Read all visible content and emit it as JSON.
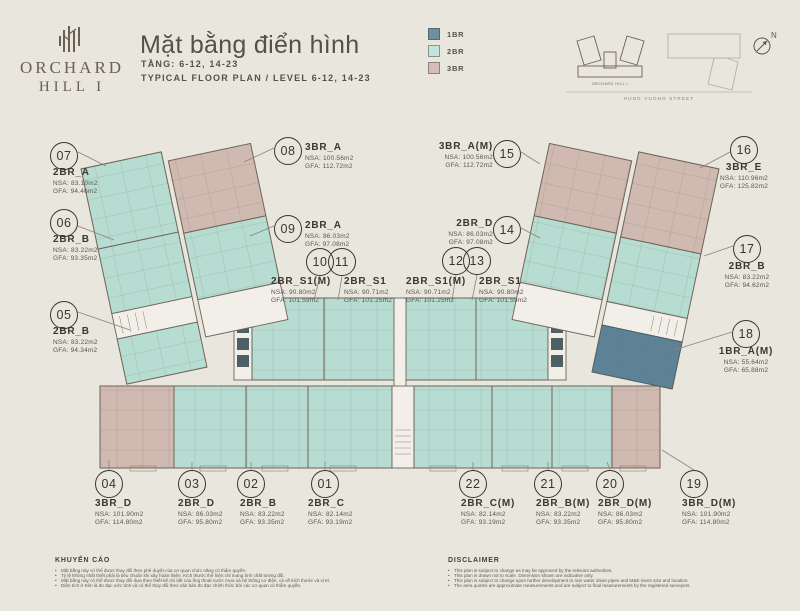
{
  "header": {
    "brand_line1": "ORCHARD",
    "brand_line2": "HILL I",
    "title": "Mặt bằng điển hình",
    "subtitle_vi": "TẦNG: 6-12, 14-23",
    "subtitle_en": "TYPICAL FLOOR PLAN / LEVEL 6-12, 14-23"
  },
  "legend": {
    "items": [
      {
        "label": "1BR",
        "color": "#6e8fa0"
      },
      {
        "label": "2BR",
        "color": "#c3e4da"
      },
      {
        "label": "3BR",
        "color": "#d4beb5"
      }
    ]
  },
  "site_key": {
    "building_label": "ORCHARD HILL I",
    "street_label": "HUNG VUONG STREET",
    "compass": "N"
  },
  "units": [
    {
      "no": "01",
      "type": "2BR_C",
      "nsa": "NSA: 82.14m2",
      "gfa": "GFA: 93.19m2"
    },
    {
      "no": "02",
      "type": "2BR_B",
      "nsa": "NSA: 83.22m2",
      "gfa": "GFA: 93.35m2"
    },
    {
      "no": "03",
      "type": "2BR_D",
      "nsa": "NSA: 86.03m2",
      "gfa": "GFA: 95.80m2"
    },
    {
      "no": "04",
      "type": "3BR_D",
      "nsa": "NSA: 101.90m2",
      "gfa": "GFA: 114.80m2"
    },
    {
      "no": "05",
      "type": "2BR_B",
      "nsa": "NSA: 83.22m2",
      "gfa": "GFA: 94.34m2"
    },
    {
      "no": "06",
      "type": "2BR_B",
      "nsa": "NSA: 83.22m2",
      "gfa": "GFA: 93.35m2"
    },
    {
      "no": "07",
      "type": "2BR_A",
      "nsa": "NSA: 83.10m2",
      "gfa": "GFA: 94.46m2"
    },
    {
      "no": "08",
      "type": "3BR_A",
      "nsa": "NSA: 100.56m2",
      "gfa": "GFA: 112.72m2"
    },
    {
      "no": "09",
      "type": "2BR_A",
      "nsa": "NSA: 86.03m2",
      "gfa": "GFA: 97.08m2"
    },
    {
      "no": "10",
      "type": "2BR_S1(M)",
      "nsa": "NSA: 90.80m2",
      "gfa": "GFA: 101.59m2"
    },
    {
      "no": "11",
      "type": "2BR_S1",
      "nsa": "NSA: 90.71m2",
      "gfa": "GFA: 101.25m2"
    },
    {
      "no": "12",
      "type": "2BR_S1(M)",
      "nsa": "NSA: 90.71m2",
      "gfa": "GFA: 101.25m2"
    },
    {
      "no": "13",
      "type": "2BR_S1",
      "nsa": "NSA: 90.80m2",
      "gfa": "GFA: 101.59m2"
    },
    {
      "no": "14",
      "type": "2BR_D",
      "nsa": "NSA: 86.03m2",
      "gfa": "GFA: 97.08m2"
    },
    {
      "no": "15",
      "type": "3BR_A(M)",
      "nsa": "NSA: 100.56m2",
      "gfa": "GFA: 112.72m2"
    },
    {
      "no": "16",
      "type": "3BR_E",
      "nsa": "NSA: 110.96m2",
      "gfa": "GFA: 125.82m2"
    },
    {
      "no": "17",
      "type": "2BR_B",
      "nsa": "NSA: 83.22m2",
      "gfa": "GFA: 94.62m2"
    },
    {
      "no": "18",
      "type": "1BR_A(M)",
      "nsa": "NSA: 55.64m2",
      "gfa": "GFA: 65.88m2"
    },
    {
      "no": "19",
      "type": "3BR_D(M)",
      "nsa": "NSA: 101.90m2",
      "gfa": "GFA: 114.80m2"
    },
    {
      "no": "20",
      "type": "2BR_D(M)",
      "nsa": "NSA: 86.03m2",
      "gfa": "GFA: 95.80m2"
    },
    {
      "no": "21",
      "type": "2BR_B(M)",
      "nsa": "NSA: 83.22m2",
      "gfa": "GFA: 93.35m2"
    },
    {
      "no": "22",
      "type": "2BR_C(M)",
      "nsa": "NSA: 82.14m2",
      "gfa": "GFA: 93.19m2"
    }
  ],
  "footer": {
    "vi": {
      "heading": "KHUYẾN CÁO",
      "bullets": [
        "Mặt bằng này có thể được thay đổi theo phê duyệt của cơ quan chức năng có thẩm quyền.",
        "Tỷ lệ không nhất thiết phải là tiêu chuẩn khi xây hoàn thiện. Kích thước thể hiện chỉ mang tính chất tương đối.",
        "Mặt bằng này có thể được thay đổi dựa theo thiết kế chi tiết của ống thoát nước mưa và hệ thống cơ điện, cả về kích thước và vị trí.",
        "Diện tích ở trên là đo đạc ước tính và có thể thay đổi theo văn bản đo đạc chính thức bởi các cơ quan có thẩm quyền."
      ]
    },
    "en": {
      "heading": "DISCLAIMER",
      "bullets": [
        "This plan is subject to change as may be approved by the relevant authorities.",
        "This plan is drawn not to scale. Dimension shown are indicative only.",
        "This plan is subject to change upon further development to rain water down pipes and M&E risers size and location.",
        "The area quotes are approximate measurements and are subject to final measurements by the registered surveyors."
      ]
    }
  }
}
